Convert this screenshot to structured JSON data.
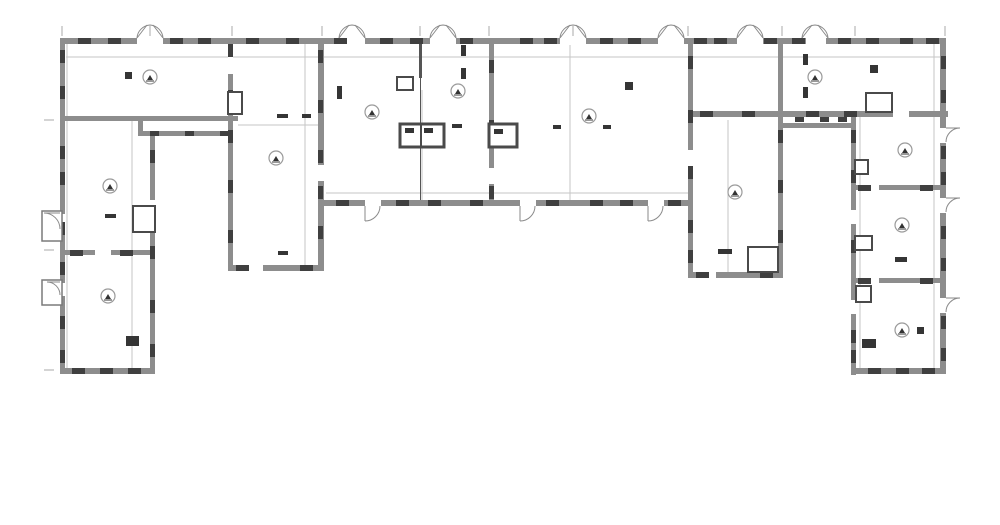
{
  "meta": {
    "type": "architectural-floor-plan",
    "description": "U-shaped building floor plan, grayscale line drawing, no visible text labels",
    "canvas": {
      "width": 1000,
      "height": 525
    }
  },
  "colors": {
    "background": "#ffffff",
    "wall": "#8d8d8d",
    "wall_dark": "#3f3f3f",
    "wall_medium": "#555555",
    "box_stroke": "#4a4a4a",
    "porch_stroke": "#7a7a7a",
    "thin_line": "#c6c6c6",
    "tick": "#aaaaaa",
    "fixture": "#353535",
    "symbol_stroke": "#9a9a9a",
    "symbol_glyph": "#333333",
    "swing": "#8a8a8a"
  },
  "plan": {
    "walls": [
      [
        60,
        38,
        885,
        6
      ],
      [
        60,
        38,
        5,
        336
      ],
      [
        60,
        368,
        95,
        6
      ],
      [
        150,
        131,
        5,
        243
      ],
      [
        60,
        250,
        92,
        5
      ],
      [
        60,
        116,
        178,
        5
      ],
      [
        138,
        131,
        95,
        5
      ],
      [
        138,
        116,
        5,
        20
      ],
      [
        228,
        38,
        5,
        233
      ],
      [
        228,
        265,
        95,
        6
      ],
      [
        318,
        38,
        6,
        233
      ],
      [
        489,
        38,
        5,
        168
      ],
      [
        318,
        200,
        375,
        6
      ],
      [
        688,
        38,
        5,
        240
      ],
      [
        688,
        272,
        95,
        6
      ],
      [
        778,
        38,
        5,
        240
      ],
      [
        688,
        111,
        260,
        6
      ],
      [
        782,
        123,
        70,
        5
      ],
      [
        940,
        38,
        6,
        336
      ],
      [
        851,
        111,
        5,
        264
      ],
      [
        851,
        185,
        95,
        5
      ],
      [
        851,
        278,
        95,
        5
      ],
      [
        856,
        368,
        90,
        6
      ],
      [
        318,
        206,
        5,
        18
      ],
      [
        688,
        206,
        5,
        18
      ]
    ],
    "gaps": [
      [
        137,
        37,
        26,
        8
      ],
      [
        339,
        37,
        26,
        8
      ],
      [
        430,
        37,
        26,
        8
      ],
      [
        560,
        37,
        26,
        8
      ],
      [
        658,
        37,
        26,
        8
      ],
      [
        737,
        37,
        26,
        8
      ],
      [
        806,
        37,
        20,
        8
      ],
      [
        365,
        199,
        16,
        8
      ],
      [
        520,
        199,
        16,
        8
      ],
      [
        648,
        199,
        16,
        8
      ],
      [
        940,
        128,
        6,
        15
      ],
      [
        940,
        198,
        6,
        15
      ],
      [
        940,
        298,
        6,
        15
      ],
      [
        60,
        214,
        5,
        15
      ],
      [
        60,
        283,
        5,
        13
      ],
      [
        228,
        56,
        5,
        18
      ],
      [
        318,
        165,
        6,
        16
      ],
      [
        489,
        168,
        5,
        16
      ],
      [
        688,
        150,
        5,
        16
      ],
      [
        893,
        110,
        16,
        7
      ],
      [
        851,
        210,
        5,
        14
      ],
      [
        851,
        300,
        5,
        14
      ],
      [
        150,
        200,
        5,
        16
      ],
      [
        95,
        250,
        16,
        5
      ],
      [
        865,
        185,
        14,
        5
      ],
      [
        865,
        278,
        14,
        5
      ],
      [
        247,
        265,
        16,
        6
      ],
      [
        700,
        272,
        16,
        6
      ]
    ],
    "piers_h": {
      "w": 13,
      "h": 6,
      "rows": [
        {
          "y": 38,
          "xs": [
            78,
            108,
            170,
            198,
            246,
            286,
            334,
            380,
            410,
            460,
            520,
            544,
            600,
            628,
            694,
            714,
            764,
            792,
            838,
            866,
            900,
            926
          ]
        },
        {
          "y": 200,
          "xs": [
            336,
            396,
            428,
            470,
            546,
            590,
            620,
            668
          ]
        },
        {
          "y": 368,
          "xs": [
            72,
            100,
            128,
            868,
            896,
            922
          ]
        },
        {
          "y": 111,
          "xs": [
            700,
            742,
            806,
            844
          ]
        },
        {
          "y": 265,
          "xs": [
            236,
            300
          ]
        },
        {
          "y": 272,
          "xs": [
            696,
            760
          ]
        },
        {
          "y": 250,
          "xs": [
            70,
            120
          ]
        },
        {
          "y": 185,
          "xs": [
            858,
            920
          ]
        },
        {
          "y": 278,
          "xs": [
            858,
            920
          ]
        }
      ]
    },
    "piers_small": {
      "w": 9,
      "h": 5,
      "rows": [
        {
          "y": 131,
          "xs": [
            150,
            185,
            220
          ]
        },
        {
          "y": 117,
          "xs": [
            795,
            820,
            838
          ]
        }
      ]
    },
    "piers_v": {
      "w": 5,
      "h": 13,
      "cols": [
        {
          "x": 60,
          "ys": [
            50,
            86,
            146,
            172,
            222,
            262,
            316,
            350
          ]
        },
        {
          "x": 941,
          "ys": [
            56,
            90,
            146,
            172,
            226,
            258,
            316,
            348
          ]
        },
        {
          "x": 150,
          "ys": [
            150,
            246,
            300,
            344
          ]
        },
        {
          "x": 228,
          "ys": [
            44,
            90,
            130,
            180,
            230
          ]
        },
        {
          "x": 318,
          "ys": [
            50,
            100,
            150,
            186,
            226
          ]
        },
        {
          "x": 489,
          "ys": [
            60,
            120,
            186
          ]
        },
        {
          "x": 688,
          "ys": [
            56,
            110,
            166,
            220,
            250
          ]
        },
        {
          "x": 778,
          "ys": [
            130,
            180,
            230
          ]
        },
        {
          "x": 851,
          "ys": [
            130,
            170,
            240,
            330,
            350
          ]
        }
      ]
    },
    "partitions": [
      [
        419,
        44,
        3,
        34
      ],
      [
        420,
        78,
        1,
        47
      ],
      [
        420,
        147,
        1,
        53
      ]
    ],
    "shaft_boxes": [
      [
        400,
        124,
        44,
        23
      ],
      [
        489,
        124,
        28,
        23
      ]
    ],
    "shaft_dividers": [
      [
        421,
        124,
        421,
        147
      ]
    ],
    "closets": [
      [
        748,
        247,
        30,
        25
      ],
      [
        866,
        93,
        26,
        19
      ],
      [
        133,
        206,
        22,
        26
      ],
      [
        855,
        160,
        13,
        14
      ],
      [
        855,
        236,
        17,
        14
      ],
      [
        856,
        286,
        15,
        16
      ],
      [
        397,
        77,
        16,
        13
      ],
      [
        228,
        92,
        14,
        22
      ]
    ],
    "porches": [
      [
        42,
        211,
        20,
        30
      ],
      [
        42,
        280,
        20,
        25
      ]
    ],
    "fixtures": [
      [
        125,
        72,
        7,
        7
      ],
      [
        105,
        214,
        11,
        4
      ],
      [
        277,
        114,
        11,
        4
      ],
      [
        302,
        114,
        9,
        4
      ],
      [
        278,
        251,
        10,
        4
      ],
      [
        452,
        124,
        10,
        4
      ],
      [
        553,
        125,
        8,
        4
      ],
      [
        603,
        125,
        8,
        4
      ],
      [
        625,
        82,
        8,
        8
      ],
      [
        718,
        249,
        14,
        5
      ],
      [
        803,
        54,
        5,
        11
      ],
      [
        803,
        87,
        5,
        11
      ],
      [
        870,
        65,
        8,
        8
      ],
      [
        895,
        257,
        12,
        5
      ],
      [
        917,
        327,
        7,
        7
      ],
      [
        862,
        339,
        14,
        9
      ],
      [
        126,
        336,
        13,
        10
      ],
      [
        337,
        86,
        5,
        13
      ],
      [
        461,
        45,
        5,
        11
      ],
      [
        461,
        68,
        5,
        11
      ],
      [
        405,
        128,
        9,
        5
      ],
      [
        424,
        128,
        9,
        5
      ],
      [
        494,
        129,
        9,
        5
      ]
    ],
    "door_swings_top": [
      150,
      352,
      443,
      573,
      671,
      750,
      815
    ],
    "door_swings_down": [
      365,
      520,
      648
    ],
    "door_swings_right": [
      128,
      198,
      298
    ],
    "door_swings_left_porch": [
      [
        60,
        213,
        16
      ],
      [
        60,
        282,
        13
      ]
    ],
    "room_symbols": [
      [
        150,
        77
      ],
      [
        110,
        186
      ],
      [
        108,
        296
      ],
      [
        276,
        158
      ],
      [
        372,
        112
      ],
      [
        458,
        91
      ],
      [
        589,
        116
      ],
      [
        735,
        192
      ],
      [
        815,
        77
      ],
      [
        905,
        150
      ],
      [
        902,
        225
      ],
      [
        902,
        330
      ]
    ],
    "thin_h": [
      [
        66,
        57,
        874
      ],
      [
        326,
        193,
        362
      ],
      [
        238,
        125,
        80
      ]
    ],
    "thin_v": [
      [
        67,
        44,
        324
      ],
      [
        132,
        120,
        248
      ],
      [
        305,
        44,
        221
      ],
      [
        728,
        120,
        152
      ],
      [
        934,
        44,
        324
      ],
      [
        860,
        116,
        252
      ],
      [
        570,
        44,
        156
      ],
      [
        422,
        90,
        110
      ]
    ],
    "ticks_top": {
      "y": 26,
      "len": 10,
      "xs": [
        62,
        150,
        232,
        322,
        420,
        489,
        573,
        688,
        782,
        855,
        945
      ]
    },
    "ticks_left": {
      "x": 44,
      "len": 10,
      "ys": [
        120,
        250,
        370
      ]
    }
  }
}
